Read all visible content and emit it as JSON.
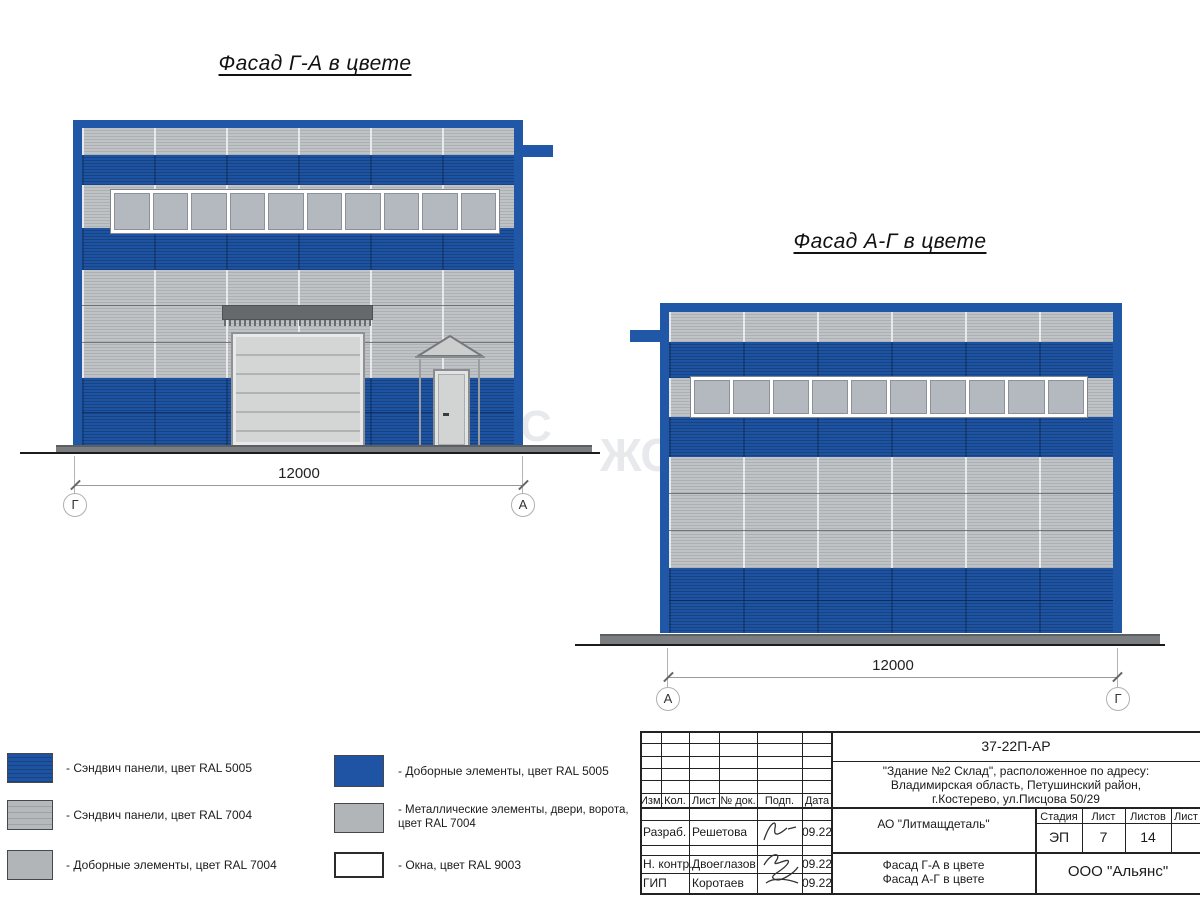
{
  "drawing": {
    "facades": [
      {
        "title": "Фасад Г-А в цвете",
        "dimension": "12000",
        "axis_left": "Г",
        "axis_right": "А",
        "windows_count": 10
      },
      {
        "title": "Фасад А-Г в цвете",
        "dimension": "12000",
        "axis_left": "А",
        "axis_right": "Г",
        "windows_count": 10
      }
    ],
    "watermarks": [
      "С",
      "ЖС"
    ]
  },
  "legend": {
    "left": [
      {
        "label": "- Сэндвич панели, цвет RAL 5005",
        "color": "#1F53A3",
        "style": "striped"
      },
      {
        "label": "- Сэндвич панели, цвет RAL 7004",
        "color": "#AFB2B5",
        "style": "striped"
      },
      {
        "label": "- Доборные элементы, цвет RAL 7004",
        "color": "#B2B5B8",
        "style": "plain"
      }
    ],
    "right": [
      {
        "label": "- Доборные элементы, цвет RAL 5005",
        "color": "#1F53A3",
        "style": "plain"
      },
      {
        "label": "- Металлические элементы, двери, ворота,",
        "label2": "цвет RAL 7004",
        "color": "#B2B5B8",
        "style": "plain"
      },
      {
        "label": "- Окна, цвет RAL 9003",
        "color": "#FFFFFF",
        "style": "outlined"
      }
    ]
  },
  "colors": {
    "ral5005_blue": "#1F53A3",
    "ral7004_gray": "#B4B7BA",
    "ral9003_white": "#FFFFFF",
    "frame_blue": "#2157A7",
    "ground": "#7B7E81"
  },
  "title_block": {
    "doc_code": "37-22П-АР",
    "address_lines": [
      "\"Здание №2 Склад\", расположенное по адресу:",
      "Владимирская область, Петушинский район,",
      "г.Костерево, ул.Писцова 50/29"
    ],
    "columns": [
      "Изм.",
      "Кол.",
      "Лист",
      "№ док.",
      "Подп.",
      "Дата"
    ],
    "rows": [
      {
        "role": "Разраб.",
        "name": "Решетова",
        "date": "09.22"
      },
      {
        "role": "Н. контр.",
        "name": "Двоеглазов",
        "date": "09.22"
      },
      {
        "role": "ГИП",
        "name": "Коротаев",
        "date": "09.22"
      }
    ],
    "organization": "АО \"Литмащдеталь\"",
    "sheet_titles": [
      "Фасад Г-А в цвете",
      "Фасад А-Г в цвете"
    ],
    "stage_label": "Стадия",
    "sheet_label": "Лист",
    "sheets_label": "Листов",
    "next_sheet_label": "Лист",
    "stage_value": "ЭП",
    "sheet_value": "7",
    "sheets_value": "14",
    "company": "ООО \"Альянс\""
  }
}
